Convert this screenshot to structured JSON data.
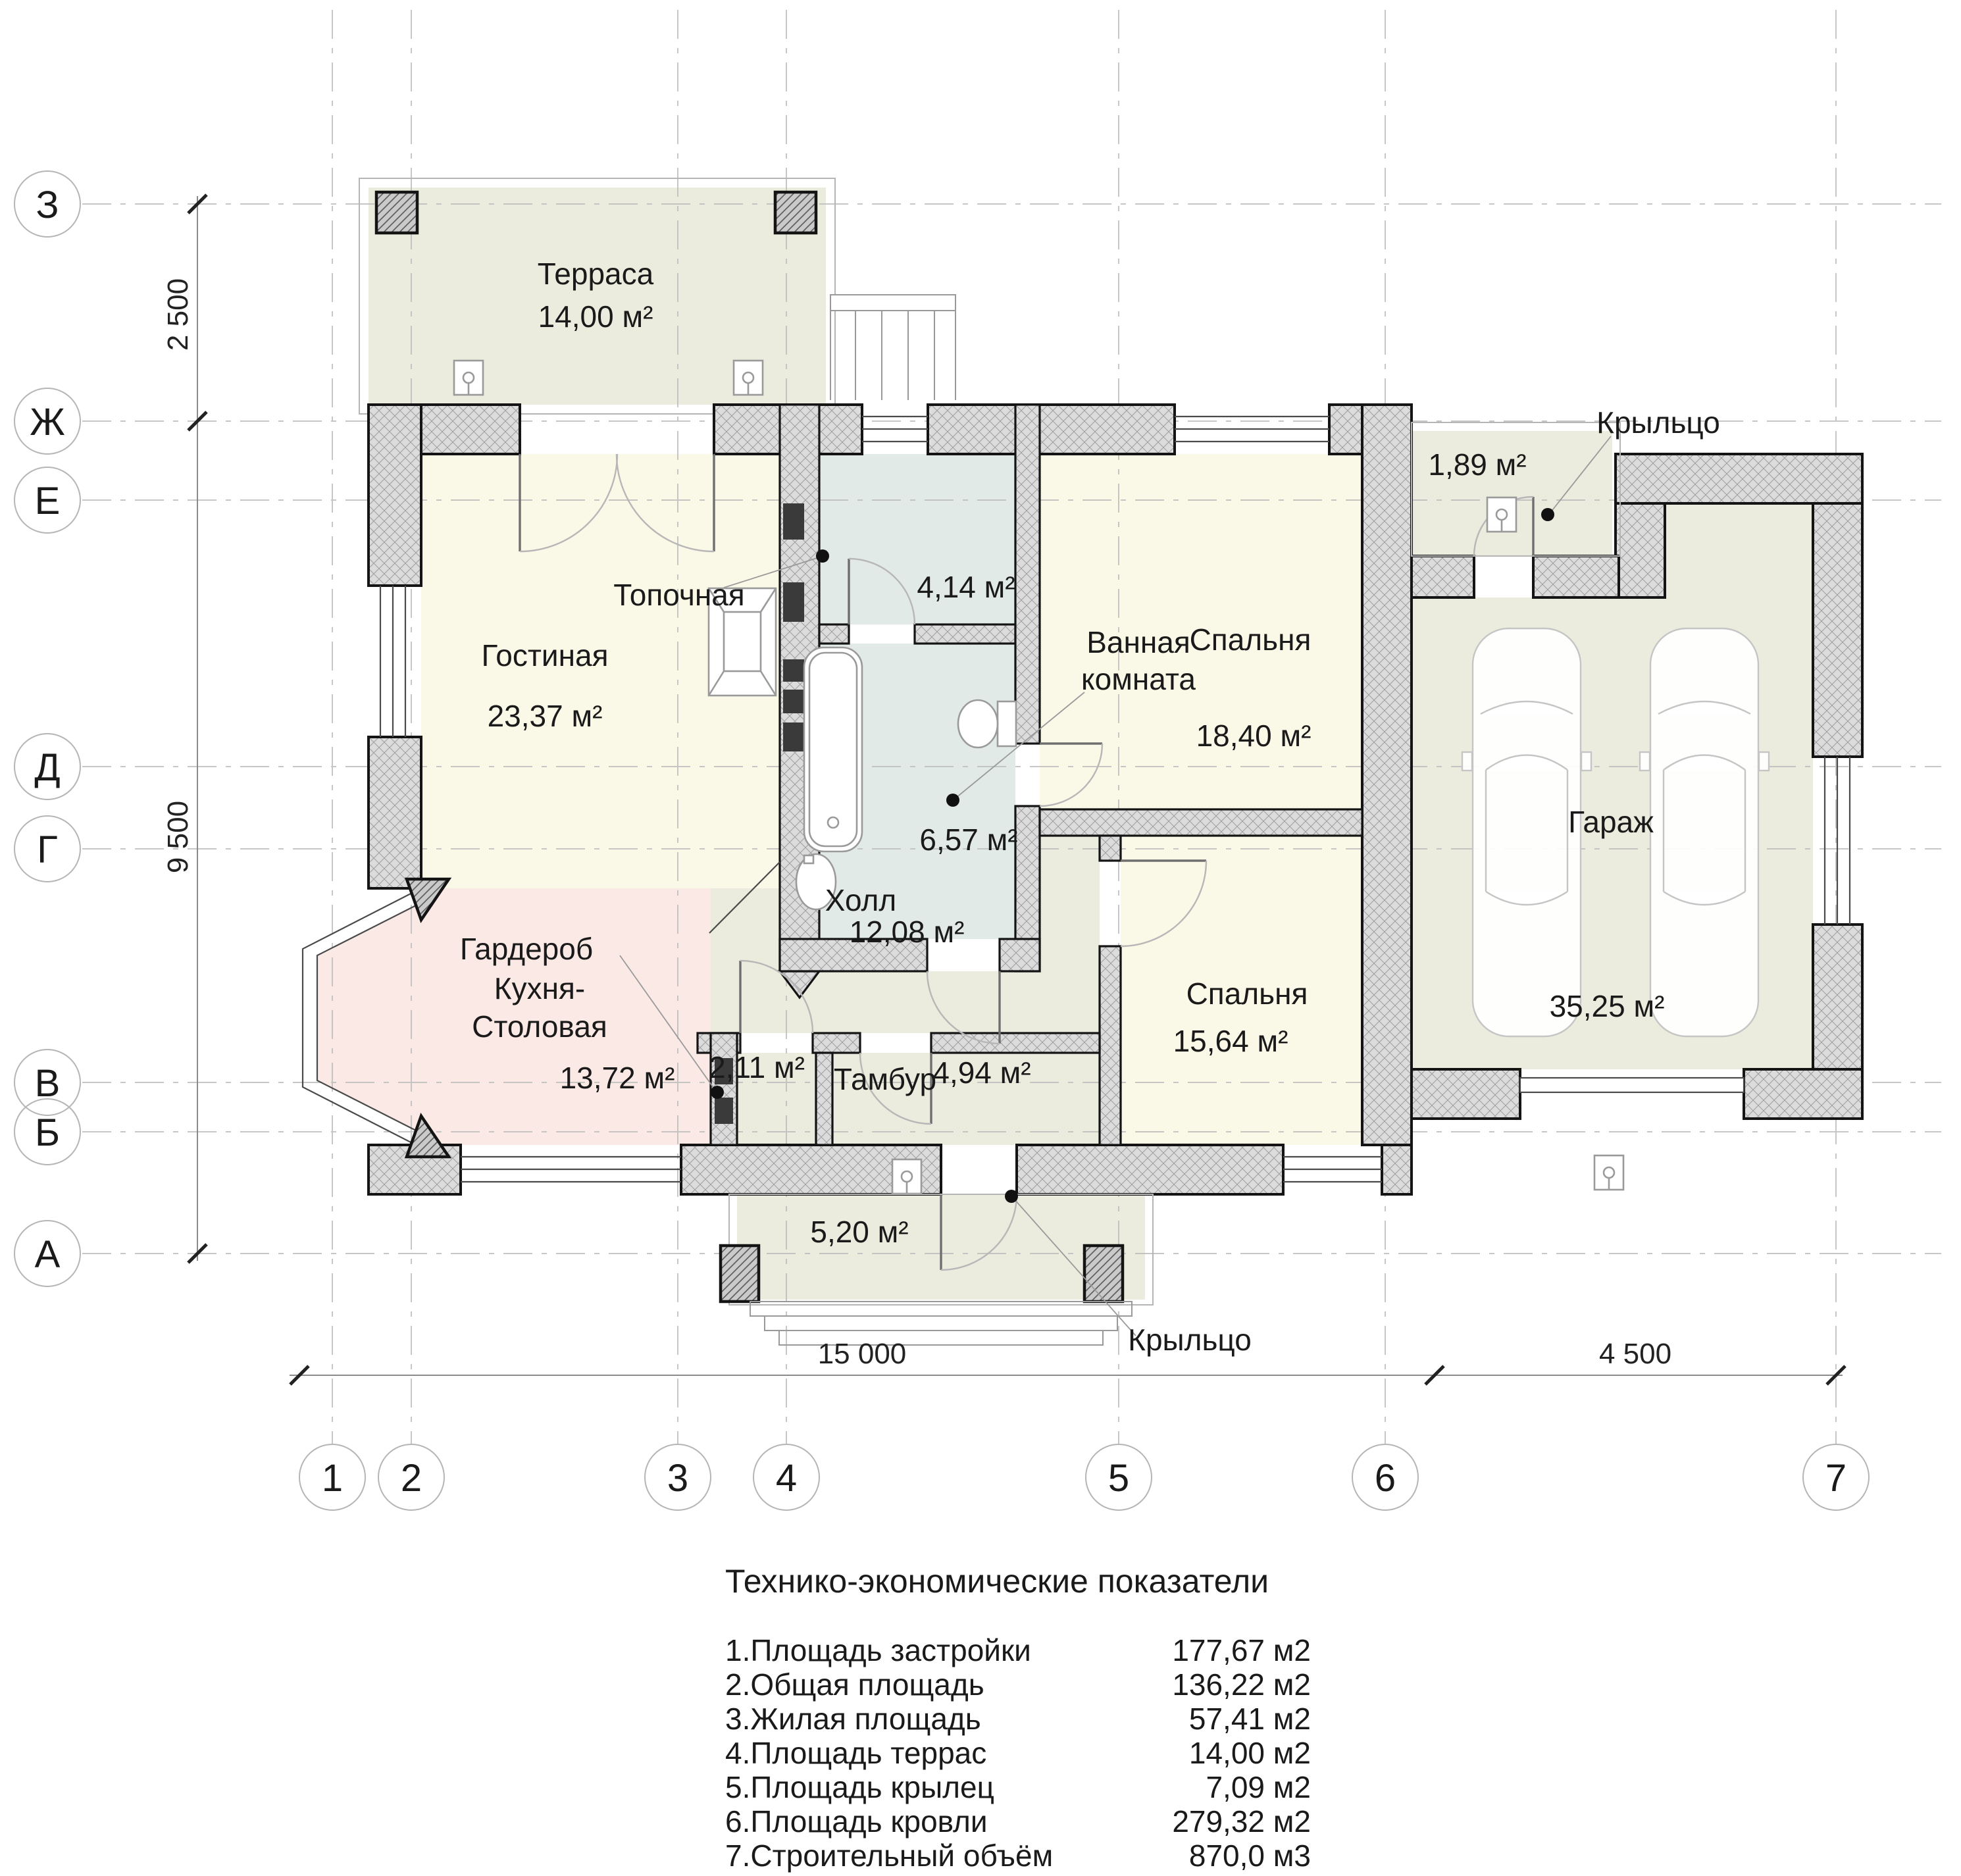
{
  "axes": {
    "rows": [
      {
        "label": "З"
      },
      {
        "label": "Ж"
      },
      {
        "label": "Е"
      },
      {
        "label": "Д"
      },
      {
        "label": "Г"
      },
      {
        "label": "В"
      },
      {
        "label": "Б"
      },
      {
        "label": "А"
      }
    ],
    "cols": [
      {
        "label": "1"
      },
      {
        "label": "2"
      },
      {
        "label": "3"
      },
      {
        "label": "4"
      },
      {
        "label": "5"
      },
      {
        "label": "6"
      },
      {
        "label": "7"
      }
    ]
  },
  "dims": {
    "v_top": "2 500",
    "v_main": "9 500",
    "h_main": "15 000",
    "h_garage": "4 500"
  },
  "rooms": {
    "terrace": {
      "name": "Терраса",
      "area": "14,00 м²"
    },
    "living": {
      "name": "Гостиная",
      "area": "23,37 м²"
    },
    "boiler": {
      "name": "Топочная",
      "area": "4,14 м²"
    },
    "bathroom": {
      "name_line1": "Ванная",
      "name_line2": "комната",
      "area": "6,57 м²"
    },
    "bedroom_top": {
      "name": "Спальня",
      "area": "18,40 м²"
    },
    "hall": {
      "name": "Холл",
      "area": "12,08 м²"
    },
    "wardrobe": {
      "name": "Гардероб",
      "area": "2,11 м²"
    },
    "kitchen": {
      "name_line1": "Кухня-",
      "name_line2": "Столовая",
      "area": "13,72 м²"
    },
    "vestibule": {
      "name": "Тамбур",
      "area": "4,94 м²"
    },
    "bedroom_bottom": {
      "name": "Спальня",
      "area": "15,64 м²"
    },
    "garage": {
      "name": "Гараж",
      "area": "35,25 м²"
    },
    "porch_back": {
      "name": "Крыльцо",
      "area": "1,89 м²"
    },
    "porch_front": {
      "name": "Крыльцо",
      "area": "5,20 м²"
    }
  },
  "table": {
    "title": "Технико-экономические показатели",
    "rows": [
      {
        "label": "1.Площадь застройки",
        "value": "177,67 м2"
      },
      {
        "label": "2.Общая площадь",
        "value": "136,22 м2"
      },
      {
        "label": "3.Жилая площадь",
        "value": "57,41 м2"
      },
      {
        "label": "4.Площадь террас",
        "value": "14,00 м2"
      },
      {
        "label": "5.Площадь крылец",
        "value": "7,09 м2"
      },
      {
        "label": "6.Площадь кровли",
        "value": "279,32 м2"
      },
      {
        "label": "7.Строительный объём",
        "value": "870,0 м3"
      }
    ]
  },
  "colors": {
    "room": "#faf8e7",
    "service": "#ebecdd",
    "wet": "#e2eae8",
    "kitchen": "#fbe9e6",
    "wall": "#dcdcdc",
    "line": "#1a1a1a"
  }
}
